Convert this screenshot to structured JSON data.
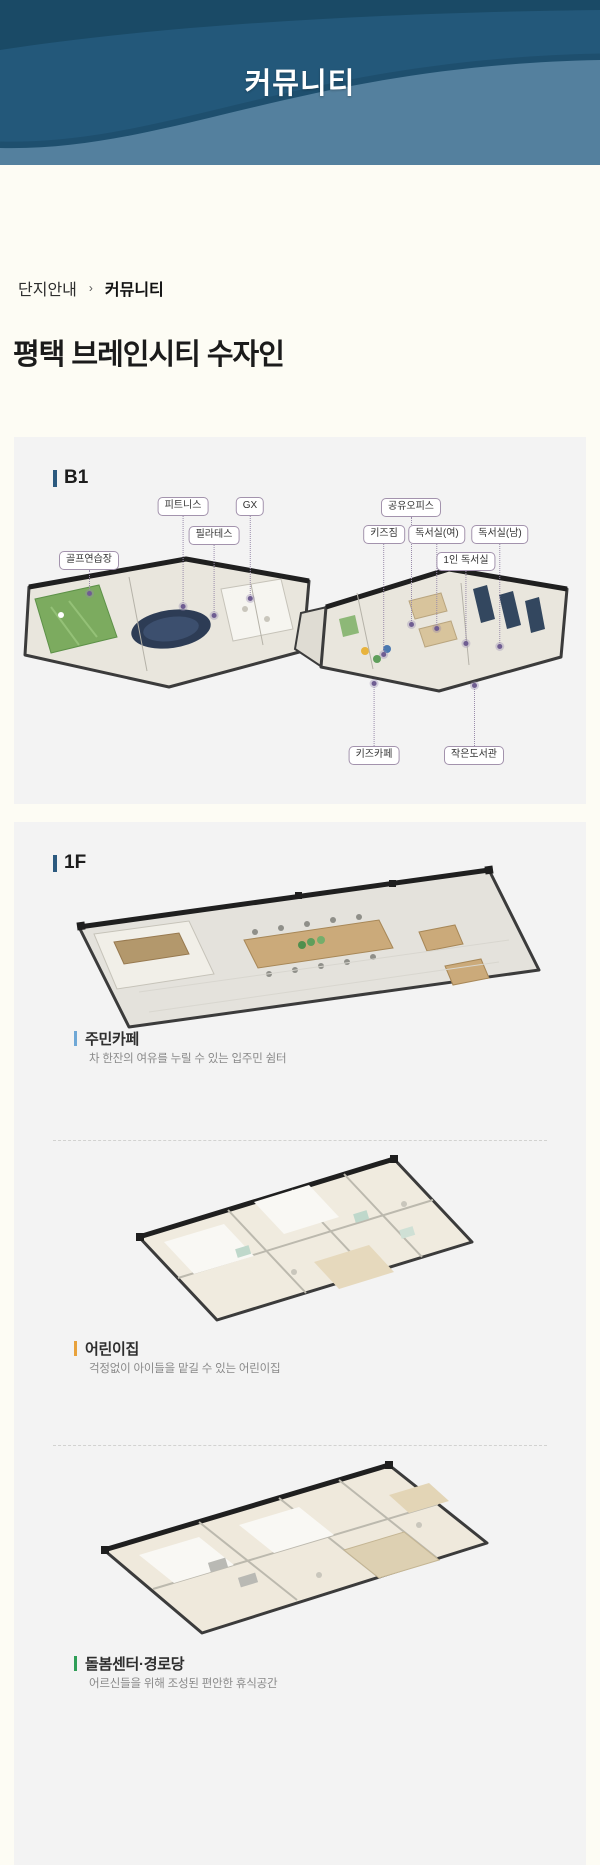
{
  "header": {
    "title": "커뮤니티"
  },
  "breadcrumb": {
    "items": [
      "단지안내",
      "커뮤니티"
    ],
    "separator": "›"
  },
  "page_title": "평택 브레인시티 수자인",
  "sections": {
    "b1": {
      "label": "B1",
      "callouts_top": [
        "피트니스",
        "GX",
        "필라테스",
        "골프연습장",
        "공유오피스",
        "키즈짐",
        "독서실(여)",
        "독서실(남)",
        "1인 독서실"
      ],
      "callouts_bottom": [
        "키즈카페",
        "작은도서관"
      ]
    },
    "f1": {
      "label": "1F",
      "facilities": [
        {
          "name": "주민카페",
          "description": "차 한잔의 여유를 누릴 수 있는 입주민 쉼터",
          "accent_color": "#6fa8d6"
        },
        {
          "name": "어린이집",
          "description": "걱정없이 아이들을 맡길 수 있는 어린이집",
          "accent_color": "#e8a23c"
        },
        {
          "name": "돌봄센터·경로당",
          "description": "어르신들을 위해 조성된 편안한 휴식공간",
          "accent_color": "#2f9e57"
        }
      ]
    }
  },
  "theme": {
    "header_bg": "#23587a",
    "header_wave": "#54809e",
    "panel_bg": "#f3f3f3",
    "floor_bar": "#2c5a7f",
    "callout_border": "#a393ad",
    "callout_line": "#9a8cab"
  }
}
